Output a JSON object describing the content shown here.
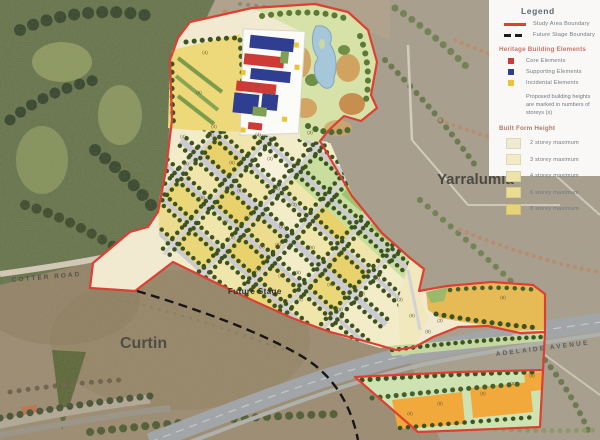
{
  "legend": {
    "title": "Legend",
    "boundaries": [
      {
        "label": "Study Area Boundary",
        "style": "solid-red"
      },
      {
        "label": "Future Stage Boundary",
        "style": "dashed-black"
      }
    ],
    "heritage": {
      "heading": "Heritage Building Elements",
      "items": [
        {
          "label": "Core Elements",
          "color": "#ce3a36"
        },
        {
          "label": "Supporting Elements",
          "color": "#2f3e90"
        },
        {
          "label": "Incidental Elements",
          "color": "#edc437"
        }
      ]
    },
    "note": "Proposed building heights are marked in numbers of storeys (x)",
    "built_form": {
      "heading": "Built Form Height",
      "items": [
        {
          "label": "2 storey maximum",
          "color": "#efead2"
        },
        {
          "label": "3 storey maximum",
          "color": "#f1ecc6"
        },
        {
          "label": "4 storey maximum",
          "color": "#eee3ab"
        },
        {
          "label": "6 storey maximum",
          "color": "#ebdc94"
        },
        {
          "label": "8 storey maximum",
          "color": "#e8d37b"
        }
      ]
    }
  },
  "colors": {
    "study_boundary": "#dd4033",
    "future_boundary": "#1d1d1d",
    "plan_base": "#f3ecc9",
    "park_green": "#d6e2a8",
    "pond_blue": "#a6c6da",
    "orange_block": "#f1a93c"
  },
  "map": {
    "labels": {
      "suburb_right": "Yarralumla",
      "suburb_left": "Curtin",
      "road_left": "COTTER ROAD",
      "road_right": "ADELAIDE AVENUE",
      "future_stage": "Future Stage"
    },
    "block_labels": [
      {
        "x": 205,
        "y": 54,
        "t": "(4)"
      },
      {
        "x": 199,
        "y": 94,
        "t": "(6)"
      },
      {
        "x": 214,
        "y": 128,
        "t": "(4)"
      },
      {
        "x": 183,
        "y": 138,
        "t": "(4)"
      },
      {
        "x": 211,
        "y": 137,
        "t": "(6)"
      },
      {
        "x": 258,
        "y": 136,
        "t": "(4)"
      },
      {
        "x": 310,
        "y": 134,
        "t": "(3)"
      },
      {
        "x": 186,
        "y": 165,
        "t": "(6)"
      },
      {
        "x": 232,
        "y": 164,
        "t": "(6)"
      },
      {
        "x": 270,
        "y": 160,
        "t": "(3)"
      },
      {
        "x": 202,
        "y": 199,
        "t": "(6)"
      },
      {
        "x": 240,
        "y": 192,
        "t": "(8)"
      },
      {
        "x": 277,
        "y": 190,
        "t": "(8)"
      },
      {
        "x": 294,
        "y": 206,
        "t": "(3)"
      },
      {
        "x": 225,
        "y": 223,
        "t": "(6)"
      },
      {
        "x": 247,
        "y": 219,
        "t": "(6)"
      },
      {
        "x": 282,
        "y": 228,
        "t": "(8)"
      },
      {
        "x": 232,
        "y": 239,
        "t": "(8)"
      },
      {
        "x": 262,
        "y": 248,
        "t": "(6)"
      },
      {
        "x": 278,
        "y": 246,
        "t": "(8)"
      },
      {
        "x": 312,
        "y": 249,
        "t": "(6)"
      },
      {
        "x": 258,
        "y": 271,
        "t": "(4)"
      },
      {
        "x": 281,
        "y": 277,
        "t": "(6)"
      },
      {
        "x": 298,
        "y": 274,
        "t": "(8)"
      },
      {
        "x": 330,
        "y": 286,
        "t": "(6)"
      },
      {
        "x": 300,
        "y": 301,
        "t": "(4)"
      },
      {
        "x": 340,
        "y": 311,
        "t": "(6)"
      },
      {
        "x": 362,
        "y": 295,
        "t": "(8)"
      },
      {
        "x": 377,
        "y": 279,
        "t": "(6)"
      },
      {
        "x": 400,
        "y": 301,
        "t": "(3)"
      },
      {
        "x": 412,
        "y": 317,
        "t": "(6)"
      },
      {
        "x": 428,
        "y": 333,
        "t": "(8)"
      },
      {
        "x": 440,
        "y": 322,
        "t": "(3)"
      },
      {
        "x": 503,
        "y": 299,
        "t": "(6)"
      },
      {
        "x": 410,
        "y": 415,
        "t": "(6)"
      },
      {
        "x": 440,
        "y": 405,
        "t": "(8)"
      },
      {
        "x": 483,
        "y": 395,
        "t": "(6)"
      },
      {
        "x": 513,
        "y": 385,
        "t": "(8)"
      },
      {
        "x": 532,
        "y": 377,
        "t": "(6)"
      }
    ]
  }
}
